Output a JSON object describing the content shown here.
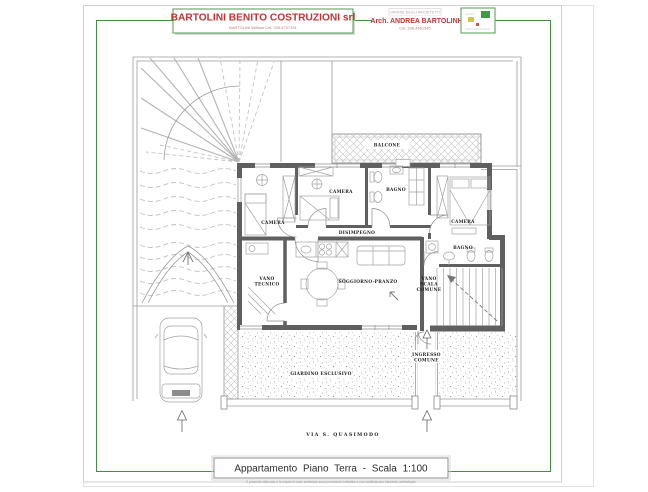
{
  "sheet": {
    "header": {
      "company_name": "BARTOLINI BENITO COSTRUZIONI srl",
      "company_contact": "BARTOLINI William Cel. 335.6757331",
      "architect_order": "ORDINE DEGLI ARCHITETTI",
      "architect_name": "Arch. ANDREA BARTOLINI",
      "architect_contact": "Cel. 338.4461545"
    },
    "footer": {
      "title": "Appartamento Piano Terra - Scala 1:100",
      "note": "Il presente elaborato e le misure in esso contenute sono puramente indicative e non costituiscono elemento contrattuale"
    }
  },
  "plan": {
    "rooms": {
      "camera_1": "CAMERA",
      "camera_2": "CAMERA",
      "camera_3": "CAMERA",
      "bagno_1": "BAGNO",
      "bagno_2": "BAGNO",
      "disimpegno": "DISIMPEGNO",
      "soggiorno": "SOGGIORNO-PRANZO",
      "vano_tecnico_l1": "VANO",
      "vano_tecnico_l2": "TECNICO",
      "vano_scala_l1": "VANO",
      "vano_scala_l2": "SCALA",
      "vano_scala_l3": "COMUNE"
    },
    "outdoor": {
      "balcone": "BALCONE",
      "giardino": "GIARDINO ESCLUSIVO",
      "ingresso_l1": "INGRESSO",
      "ingresso_l2": "COMUNE",
      "via": "VIA S. QUASIMODO"
    }
  },
  "colors": {
    "frame_green": "#3f8f43",
    "title_red": "#bf3434",
    "wall_gray": "#5f5f5f"
  }
}
